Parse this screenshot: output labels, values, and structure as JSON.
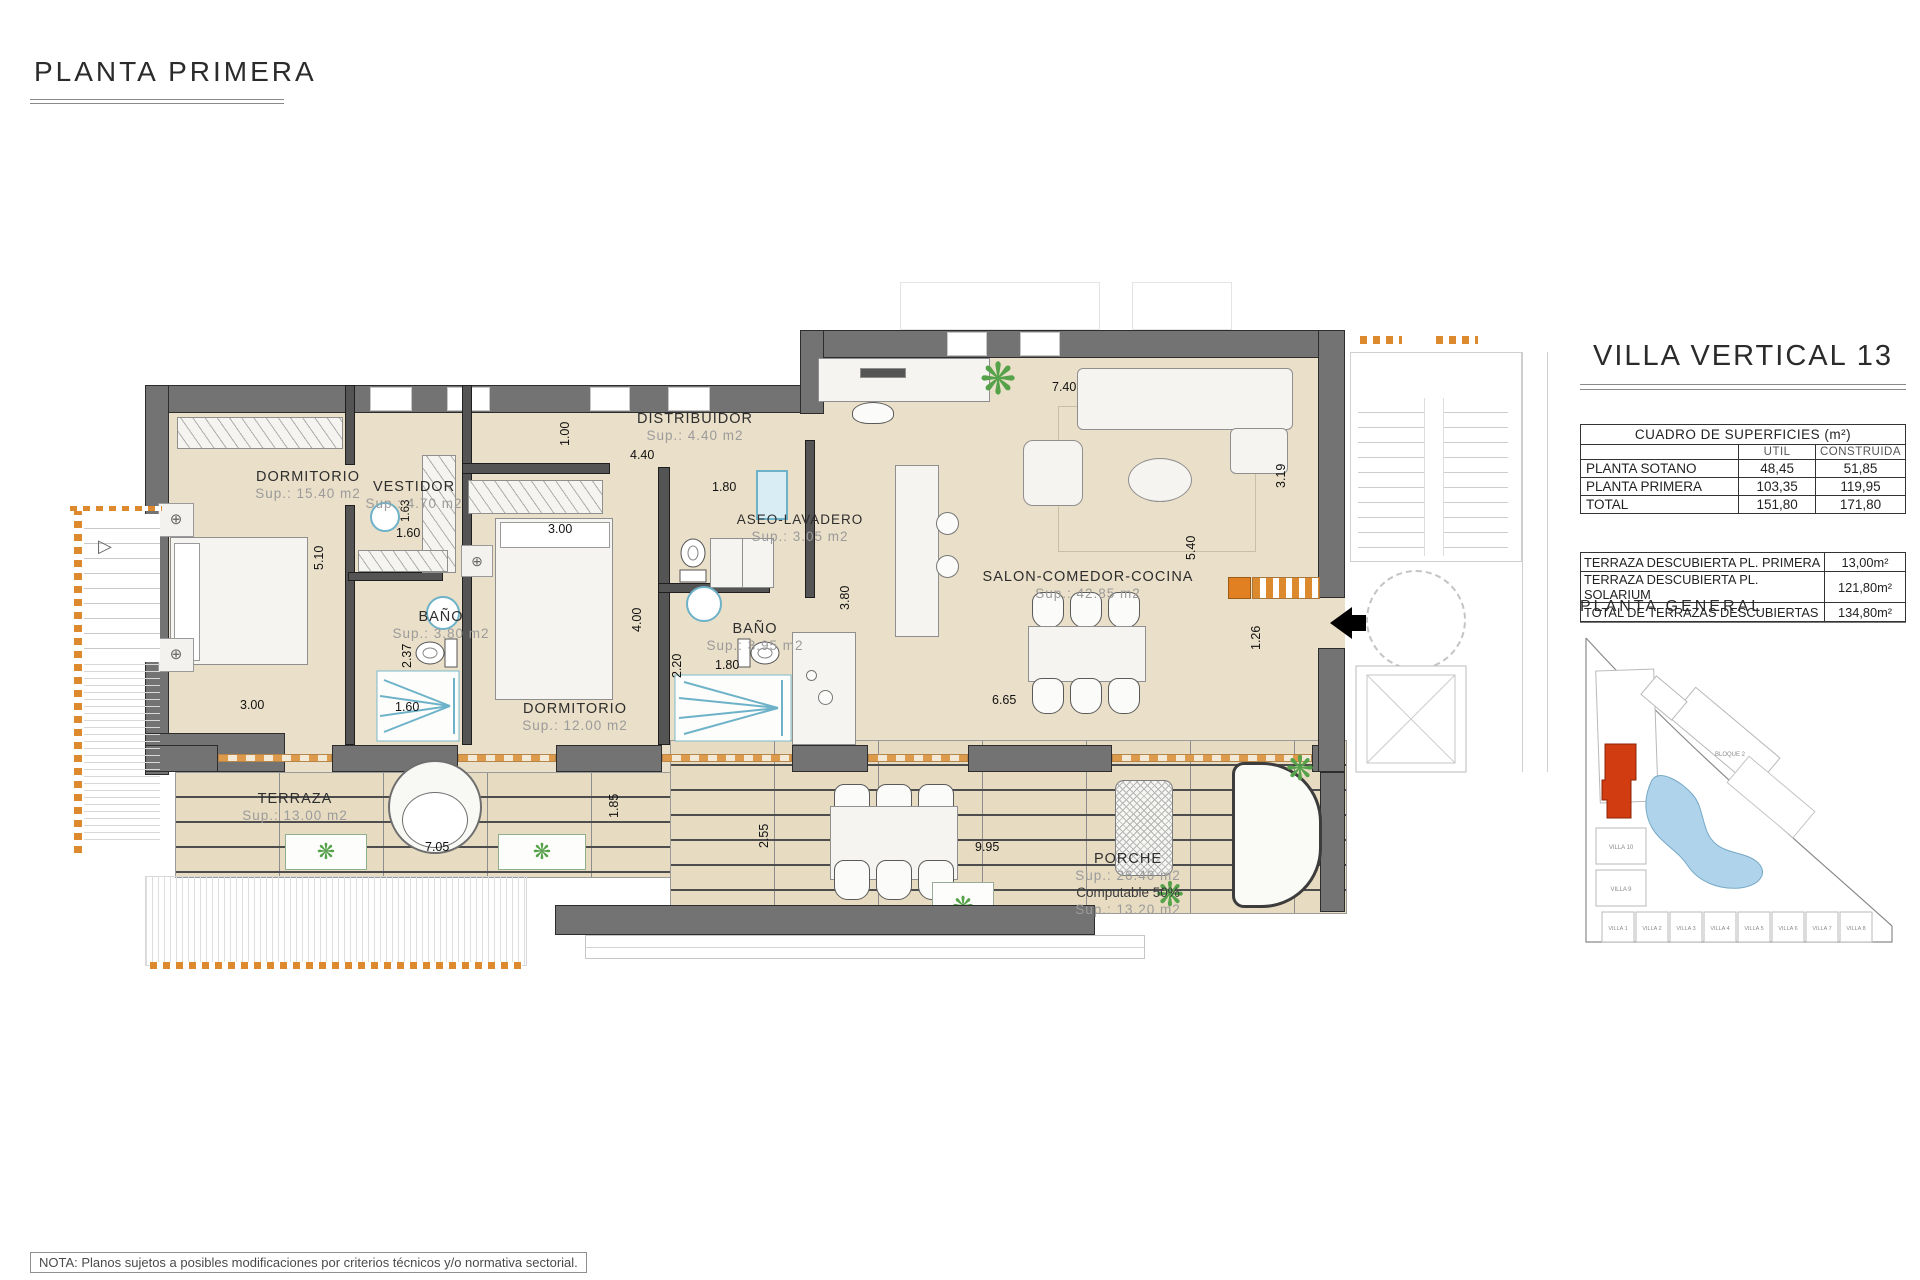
{
  "page": {
    "title": "PLANTA PRIMERA",
    "note": "NOTA: Planos sujetos a posibles modificaciones por criterios técnicos y/o normativa sectorial."
  },
  "plan": {
    "rooms": {
      "dorm1": {
        "name": "DORMITORIO",
        "sup": "Sup.: 15.40  m2"
      },
      "vestidor": {
        "name": "VESTIDOR",
        "sup": "Sup.: 4.70   m2"
      },
      "bano1": {
        "name": "BAÑO",
        "sup": "Sup.: 3.80   m2"
      },
      "dorm2": {
        "name": "DORMITORIO",
        "sup": "Sup.: 12.00 m2"
      },
      "distribuidor": {
        "name": "DISTRIBUIDOR",
        "sup": "Sup.: 4.40   m2"
      },
      "aseo": {
        "name": "ASEO-LAVADERO",
        "sup": "Sup.: 3.05   m2"
      },
      "bano2": {
        "name": "BAÑO",
        "sup": "Sup.: 3.95   m2"
      },
      "salon": {
        "name": "SALON-COMEDOR-COCINA",
        "sup": "Sup.: 42.85 m2"
      },
      "terraza": {
        "name": "TERRAZA",
        "sup": "Sup.: 13.00 m2"
      },
      "porche": {
        "name": "PORCHE",
        "sup": "Sup.: 26.40 m2",
        "computable": "Computable 50%",
        "sup2": "Sup.: 13.20 m2"
      }
    },
    "dims": [
      "5.10",
      "3.00",
      "1.63",
      "1.60",
      "2.37",
      "1.60",
      "1.00",
      "4.40",
      "3.00",
      "4.00",
      "1.80",
      "2.20",
      "1.80",
      "3.80",
      "7.40",
      "5.40",
      "3.19",
      "1.26",
      "6.65",
      "7.05",
      "2.55",
      "9.95",
      "1.85"
    ],
    "symbols": {
      "target": "⊕",
      "plant": "❋",
      "stair_arrow": "▷"
    }
  },
  "panel": {
    "title": "VILLA VERTICAL 13",
    "surfaces": {
      "title": "CUADRO DE SUPERFICIES (m²)",
      "col_util": "UTIL",
      "col_construida": "CONSTRUIDA",
      "rows": [
        {
          "label": "PLANTA SOTANO",
          "util": "48,45",
          "construida": "51,85"
        },
        {
          "label": "PLANTA PRIMERA",
          "util": "103,35",
          "construida": "119,95"
        },
        {
          "label": "TOTAL",
          "util": "151,80",
          "construida": "171,80"
        }
      ]
    },
    "terraces": {
      "rows": [
        {
          "label": "TERRAZA DESCUBIERTA PL. PRIMERA",
          "value": "13,00m²"
        },
        {
          "label": "TERRAZA DESCUBIERTA PL. SOLARIUM",
          "value": "121,80m²"
        },
        {
          "label": "TOTAL DE TERRAZAS DESCUBIERTAS",
          "value": "134,80m²"
        }
      ]
    },
    "site": {
      "title": "PLANTA GENERAL",
      "bloque": "BLOQUE 2",
      "villa10": "VILLA 10",
      "villa9": "VILLA 9",
      "villas_row": [
        "VILLA 1",
        "VILLA 2",
        "VILLA 3",
        "VILLA 4",
        "VILLA 5",
        "VILLA 6",
        "VILLA 7",
        "VILLA 8"
      ],
      "highlight_color": "#d13c10",
      "pool_color": "#aed3ea"
    }
  }
}
